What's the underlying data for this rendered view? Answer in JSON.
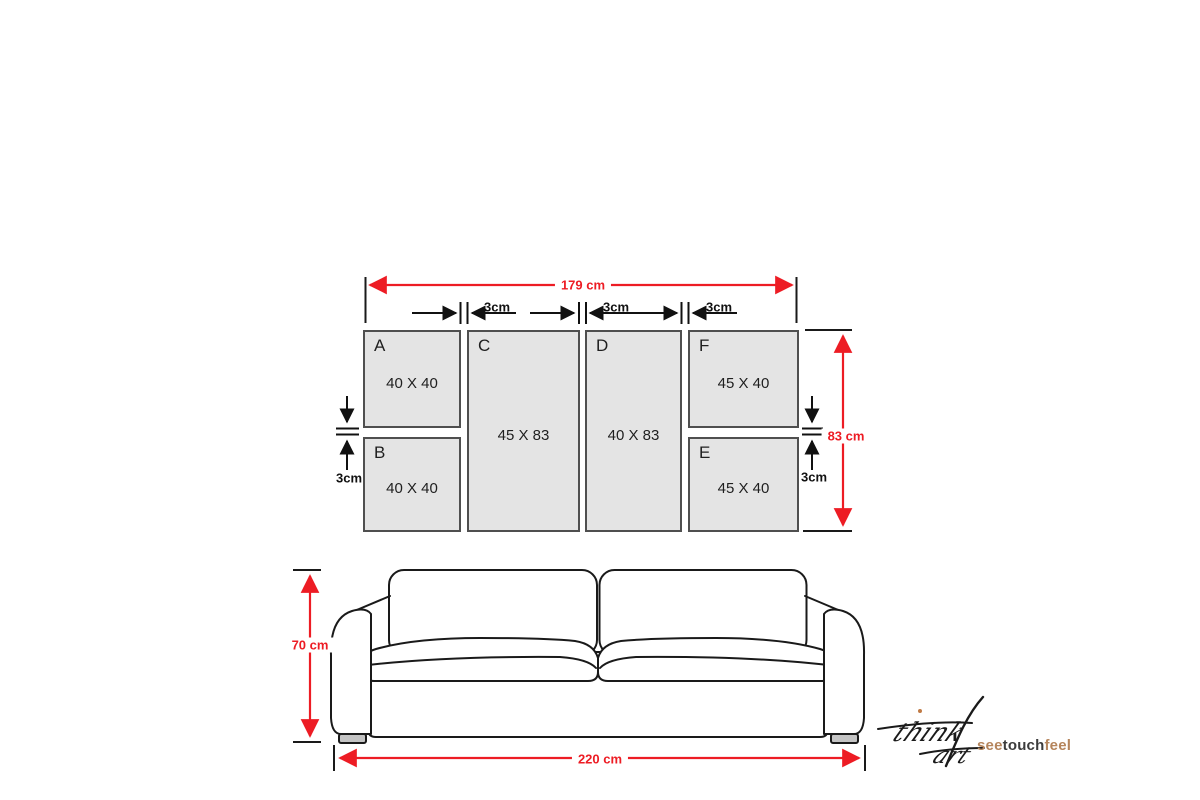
{
  "diagram": {
    "description": "Six-piece wall art panel size layout shown above a sofa",
    "colors": {
      "dimension_red": "#ed1c24",
      "panel_fill": "#e4e4e4",
      "panel_border": "#4f4f4f",
      "sofa_line": "#1a1a1a",
      "foot_fill": "#c4c4c4",
      "logo_accent": "#b5855c",
      "logo_dark": "#3c3c3c"
    }
  },
  "panels": [
    {
      "id": "A",
      "letter": "A",
      "size": "40 X 40"
    },
    {
      "id": "B",
      "letter": "B",
      "size": "40 X 40"
    },
    {
      "id": "C",
      "letter": "C",
      "size": "45 X 83"
    },
    {
      "id": "D",
      "letter": "D",
      "size": "40 X 83"
    },
    {
      "id": "F",
      "letter": "F",
      "size": "45 X 40"
    },
    {
      "id": "E",
      "letter": "E",
      "size": "45 X 40"
    }
  ],
  "dimensions": {
    "total_width": "179 cm",
    "total_height": "83 cm",
    "gap_top_1": "3cm",
    "gap_top_2": "3cm",
    "gap_top_3": "3cm",
    "gap_left": "3cm",
    "gap_right": "3cm",
    "sofa_height": "70 cm",
    "sofa_width": "220 cm"
  },
  "logo": {
    "script_line1": "think",
    "script_line2": "art",
    "tagline": [
      {
        "text": "see",
        "color": "#b5855c"
      },
      {
        "text": "touch",
        "color": "#3c3c3c"
      },
      {
        "text": "feel",
        "color": "#b5855c"
      }
    ]
  }
}
